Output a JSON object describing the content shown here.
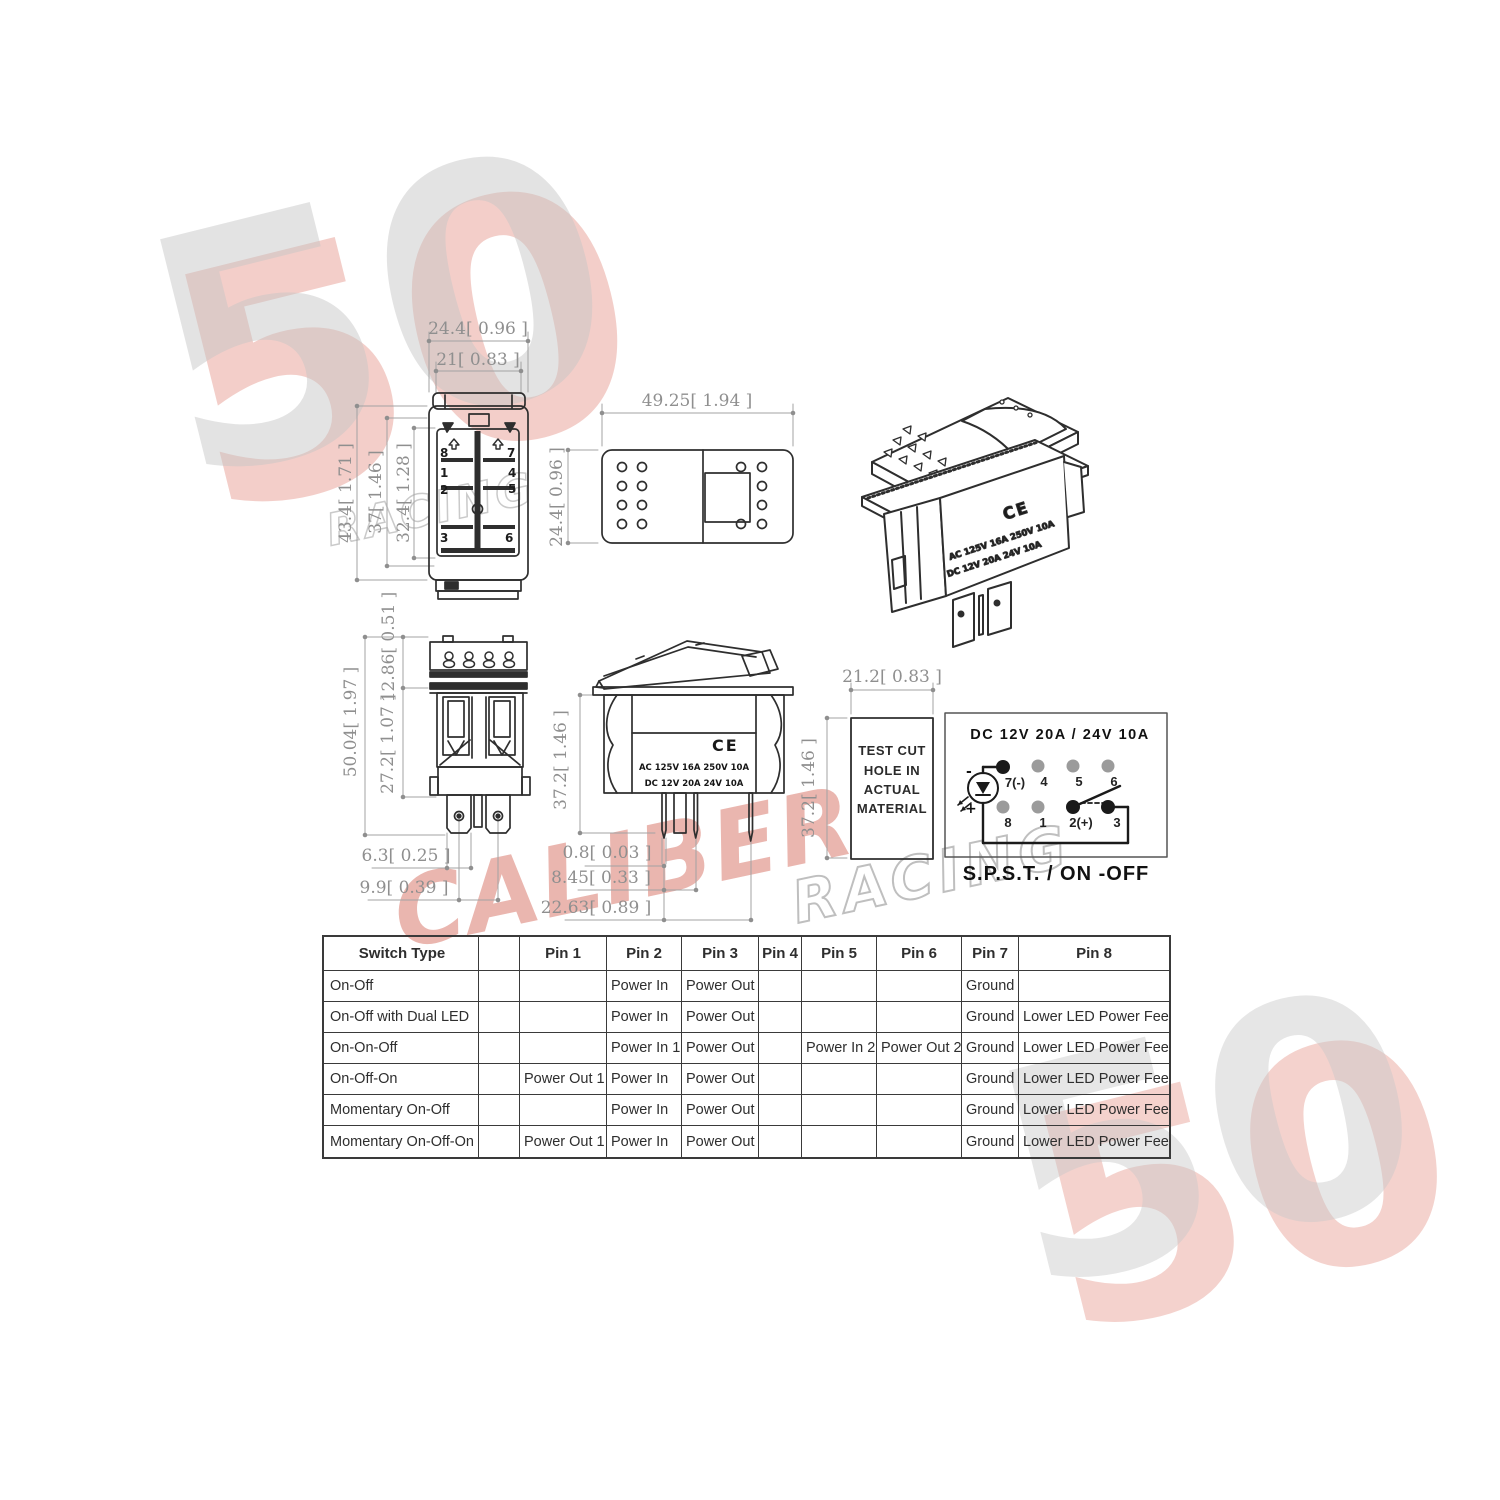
{
  "watermark": {
    "number": "50",
    "caliber": "CALIBER",
    "racing": "RACING",
    "red": "#cd4a3a",
    "gray": "#c6c6c6"
  },
  "views": {
    "rear": {
      "dims": {
        "outer_width": "24.4[ 0.96 ]",
        "inner_width": "21[ 0.83 ]",
        "outer_height": "43.4[ 1.71 ]",
        "body_height": "37[ 1.46 ]",
        "inner_height": "32.4[ 1.28 ]"
      },
      "pins": [
        "8",
        "7",
        "1",
        "4",
        "2",
        "5",
        "3",
        "6"
      ]
    },
    "panel_cutout": {
      "dims": {
        "width": "49.25[ 1.94 ]",
        "height": "24.4[ 0.96 ]"
      }
    },
    "perspective": {
      "ce_mark": "CE",
      "marking_line1": "AC 125V 16A 250V 10A",
      "marking_line2": "DC 12V 20A 24V 10A"
    },
    "front": {
      "dims": {
        "terminal_height": "12.86[ 0.51 ]",
        "total_height": "50.04[ 1.97 ]",
        "body_height": "27.2[ 1.07 ]",
        "leg_width": "6.3[ 0.25 ]",
        "hole_spacing": "9.9[ 0.39 ]"
      }
    },
    "side": {
      "dims": {
        "height": "37.2[ 1.46 ]",
        "pin_thickness": "0.8[ 0.03 ]",
        "pin_offset1": "8.45[ 0.33 ]",
        "pin_offset2": "22.63[ 0.89 ]"
      },
      "ce_mark": "CE",
      "rating_line1": "AC 125V 16A 250V 10A",
      "rating_line2": "DC 12V 20A 24V 10A"
    },
    "test_hole": {
      "dims": {
        "width": "21.2[ 0.83 ]",
        "height": "37.2[ 1.46 ]"
      },
      "line1": "TEST CUT",
      "line2": "HOLE IN",
      "line3": "ACTUAL",
      "line4": "MATERIAL"
    },
    "wiring": {
      "title": "DC  12V  20A  /  24V  10A",
      "pins_top": [
        "7(-)",
        "4",
        "5",
        "6"
      ],
      "pins_bottom": [
        "8",
        "1",
        "2(+)",
        "3"
      ],
      "led_minus": "-",
      "led_plus": "+",
      "caption": "S.P.S.T. /  ON -OFF",
      "active_dot_color": "#1a1a1a",
      "inactive_dot_color": "#9b9b9b"
    }
  },
  "table": {
    "columns": [
      "Switch Type",
      "",
      "Pin 1",
      "Pin 2",
      "Pin 3",
      "Pin 4",
      "Pin 5",
      "Pin 6",
      "Pin 7",
      "Pin 8"
    ],
    "rows": [
      [
        "On-Off",
        "",
        "",
        "Power In",
        "Power Out",
        "",
        "",
        "",
        "Ground",
        ""
      ],
      [
        "On-Off with Dual LED",
        "",
        "",
        "Power In",
        "Power Out",
        "",
        "",
        "",
        "Ground",
        "Lower LED Power Feed"
      ],
      [
        "On-On-Off",
        "",
        "",
        "Power In 1",
        "Power Out 1",
        "",
        "Power In 2",
        "Power Out 2",
        "Ground",
        "Lower LED Power Feed"
      ],
      [
        "On-Off-On",
        "",
        "Power Out 1",
        "Power In",
        "Power Out 2",
        "",
        "",
        "",
        "Ground",
        "Lower LED Power Feed"
      ],
      [
        "Momentary On-Off",
        "",
        "",
        "Power In",
        "Power Out",
        "",
        "",
        "",
        "Ground",
        "Lower LED Power Feed"
      ],
      [
        "Momentary On-Off-On",
        "",
        "Power Out 1",
        "Power In",
        "Power Out 2",
        "",
        "",
        "",
        "Ground",
        "Lower LED Power Feed"
      ]
    ]
  }
}
